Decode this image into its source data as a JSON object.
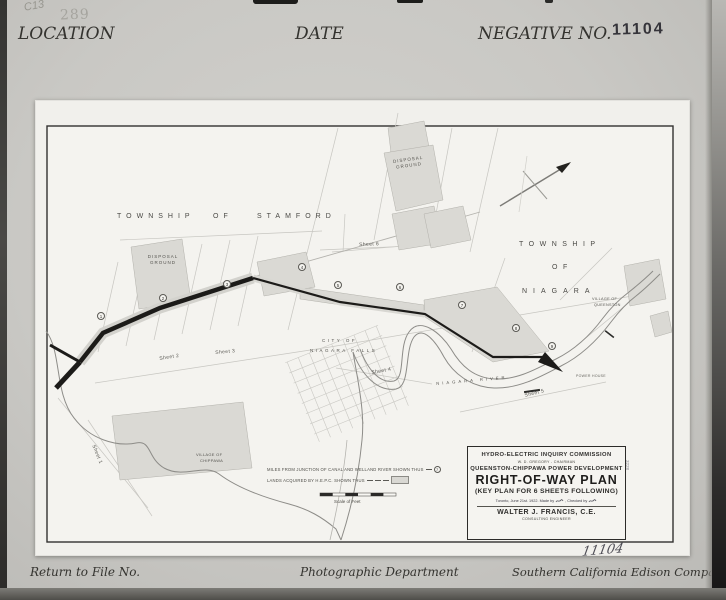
{
  "card": {
    "header": {
      "pencil_note": "C13",
      "faint_stamp": "289",
      "location_label": "LOCATION",
      "date_label": "DATE",
      "negative_label": "NEGATIVE NO.",
      "negative_number_stamp": "11104"
    },
    "footer": {
      "return_label": "Return to File No.",
      "department_label": "Photographic Department",
      "company_label": "Southern California Edison Company"
    },
    "handwritten_number": "11104"
  },
  "map": {
    "townships": {
      "stamford": {
        "word1": "TOWNSHIP",
        "word2": "OF",
        "word3": "STAMFORD"
      },
      "niagara": {
        "word1": "TOWNSHIP",
        "word2": "OF",
        "word3": "NIAGARA"
      }
    },
    "places": {
      "disposal_ground_top": "DISPOSAL GROUND",
      "disposal_ground_left": "DISPOSAL GROUND",
      "city_line1": "CITY OF",
      "city_line2": "NIAGARA FALLS",
      "village_chippawa_line1": "VILLAGE OF",
      "village_chippawa_line2": "CHIPPAWA",
      "village_queenston_line1": "VILLAGE OF",
      "village_queenston_line2": "QUEENSTON",
      "river_label": "NIAGARA RIVER",
      "power_house": "POWER HOUSE"
    },
    "sheets": [
      {
        "label": "Sheet 1"
      },
      {
        "label": "Sheet 2"
      },
      {
        "label": "Sheet 3"
      },
      {
        "label": "Sheet 4"
      },
      {
        "label": "Sheet 5"
      },
      {
        "label": "Sheet 6"
      }
    ],
    "mile_markers": [
      "1",
      "2",
      "3",
      "4",
      "5",
      "6",
      "7",
      "8",
      "9"
    ],
    "legend": {
      "miles_line": "MILES FROM JUNCTION OF CANAL AND WELLAND RIVER SHOWN THUS",
      "miles_symbol": "7",
      "lands_line": "LANDS ACQUIRED BY H.E.P.C. SHOWN THUS",
      "scale_label": "Scale of Feet"
    },
    "title_block": {
      "line1": "HYDRO-ELECTRIC INQUIRY COMMISSION",
      "line2": "W. D. GREGORY - CHAIRMAN",
      "line3": "QUEENSTON-CHIPPAWA POWER DEVELOPMENT",
      "title": "RIGHT-OF-WAY PLAN",
      "subtitle": "(KEY PLAN FOR 6 SHEETS FOLLOWING)",
      "date_line": "Toronto, June 21st. 1922.  Made by",
      "checked_line": ", Checked by",
      "engineer": "WALTER J. FRANCIS, C.E.",
      "engineer_title": "CONSULTING ENGINEER"
    },
    "margin_number": "3228"
  }
}
